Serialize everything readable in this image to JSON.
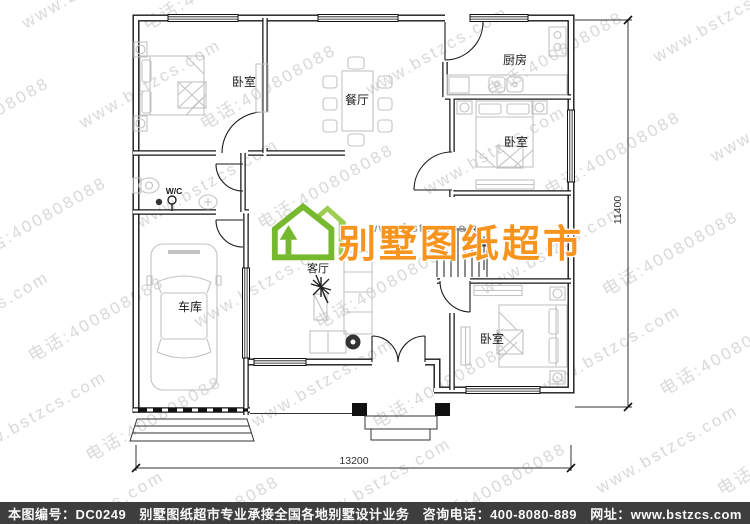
{
  "watermark": {
    "line1": "www.bstzcs.com",
    "line2": "电话:4008080889",
    "color": "#d8d8d8"
  },
  "logo": {
    "site_url": "www.bstzcs.com",
    "brand_text": "别墅图纸超市",
    "green": "#76b82e",
    "orange": "#f7941d"
  },
  "floorplan": {
    "rooms": {
      "bedroom_top_left": "卧室",
      "dining": "餐厅",
      "kitchen": "厨房",
      "bedroom_right": "卧室",
      "wc": "W/C",
      "garage": "车库",
      "living": "客厅",
      "bedroom_bottom_right": "卧室"
    },
    "dimensions": {
      "width": "13200",
      "height": "11400"
    }
  },
  "footer": {
    "bg": "#3e3e3e",
    "sheet_no": "本图编号：DC0249",
    "slogan": "别墅图纸超市专业承接全国各地别墅设计业务",
    "phone": "咨询电话：400-8080-889",
    "website": "网址：www.bstzcs.com"
  }
}
